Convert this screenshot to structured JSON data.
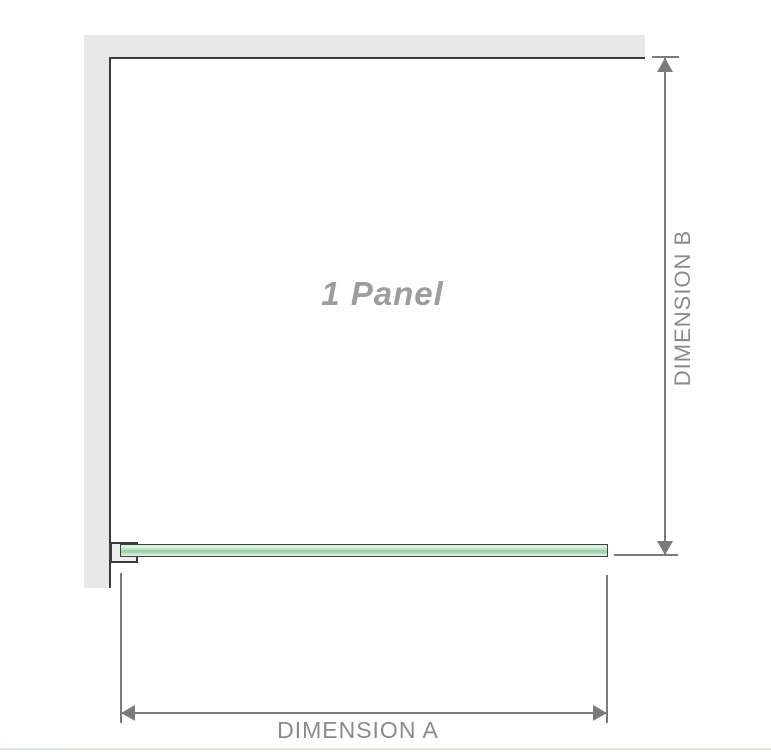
{
  "diagram": {
    "title": "1 Panel shower screen plan-view dimension diagram",
    "labels": {
      "panel": "1 Panel",
      "dimension_a": "DIMENSION A",
      "dimension_b": "DIMENSION B"
    },
    "colors": {
      "wall": "#e8e8e8",
      "edge": "#3b3b3b",
      "dim": "#7a7a7a",
      "dim-text": "#8b8b8b",
      "panel-text": "#9d9d9d",
      "glass-light": "#d2ead7",
      "glass-mid": "#9bcfa6",
      "glass-border": "#35463c",
      "clamp-fill": "#efefef",
      "footer-line": "#e8e4dd",
      "footer-line-accent": "#dce3e9"
    }
  }
}
